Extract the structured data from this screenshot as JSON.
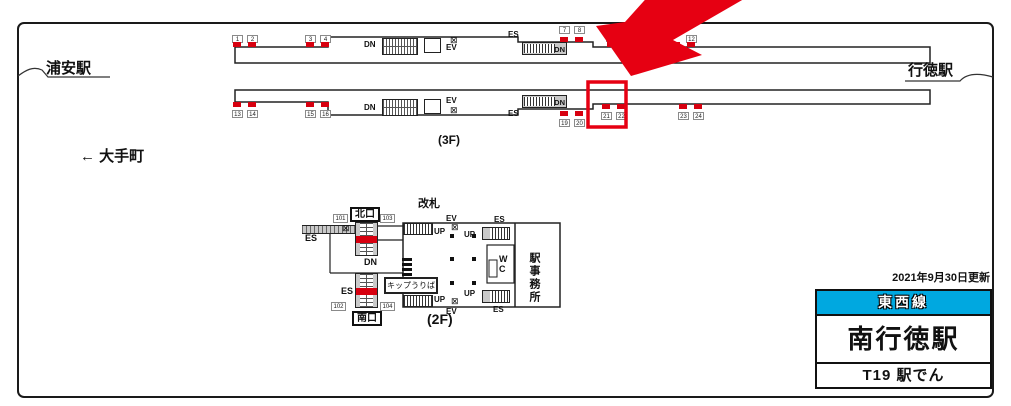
{
  "stations": {
    "left_station": "浦安駅",
    "right_station": "行徳駅",
    "direction": "← 大手町"
  },
  "labels": {
    "up": "UP",
    "dn": "DN",
    "es": "ES",
    "ev": "EV",
    "floor3": "(3F)",
    "floor2": "(2F)",
    "gate": "改札",
    "north_exit": "北口",
    "south_exit": "南口",
    "ticket_machines": "キップうりば",
    "wc_w": "W",
    "wc_c": "C",
    "station_office": "駅事務所"
  },
  "symbols": {
    "elevator": "⊠"
  },
  "platform3f": {
    "top_ad_numbers": [
      "1",
      "2",
      "3",
      "4",
      "7",
      "8",
      "9",
      "10",
      "12"
    ],
    "bottom_ad_numbers": [
      "13",
      "14",
      "15",
      "16",
      "19",
      "20",
      "21",
      "22",
      "23",
      "24"
    ]
  },
  "concourse2f": {
    "ad_numbers": [
      "101",
      "103",
      "102",
      "104"
    ]
  },
  "info_panel": {
    "updated": "2021年9月30日更新",
    "line_name": "東西線",
    "station_name": "南行徳駅",
    "product_label": "T19 駅でん"
  },
  "colors": {
    "highlight_red": "#E60012",
    "marker_red": "#D7000F",
    "line_cyan": "#00A8E0"
  }
}
